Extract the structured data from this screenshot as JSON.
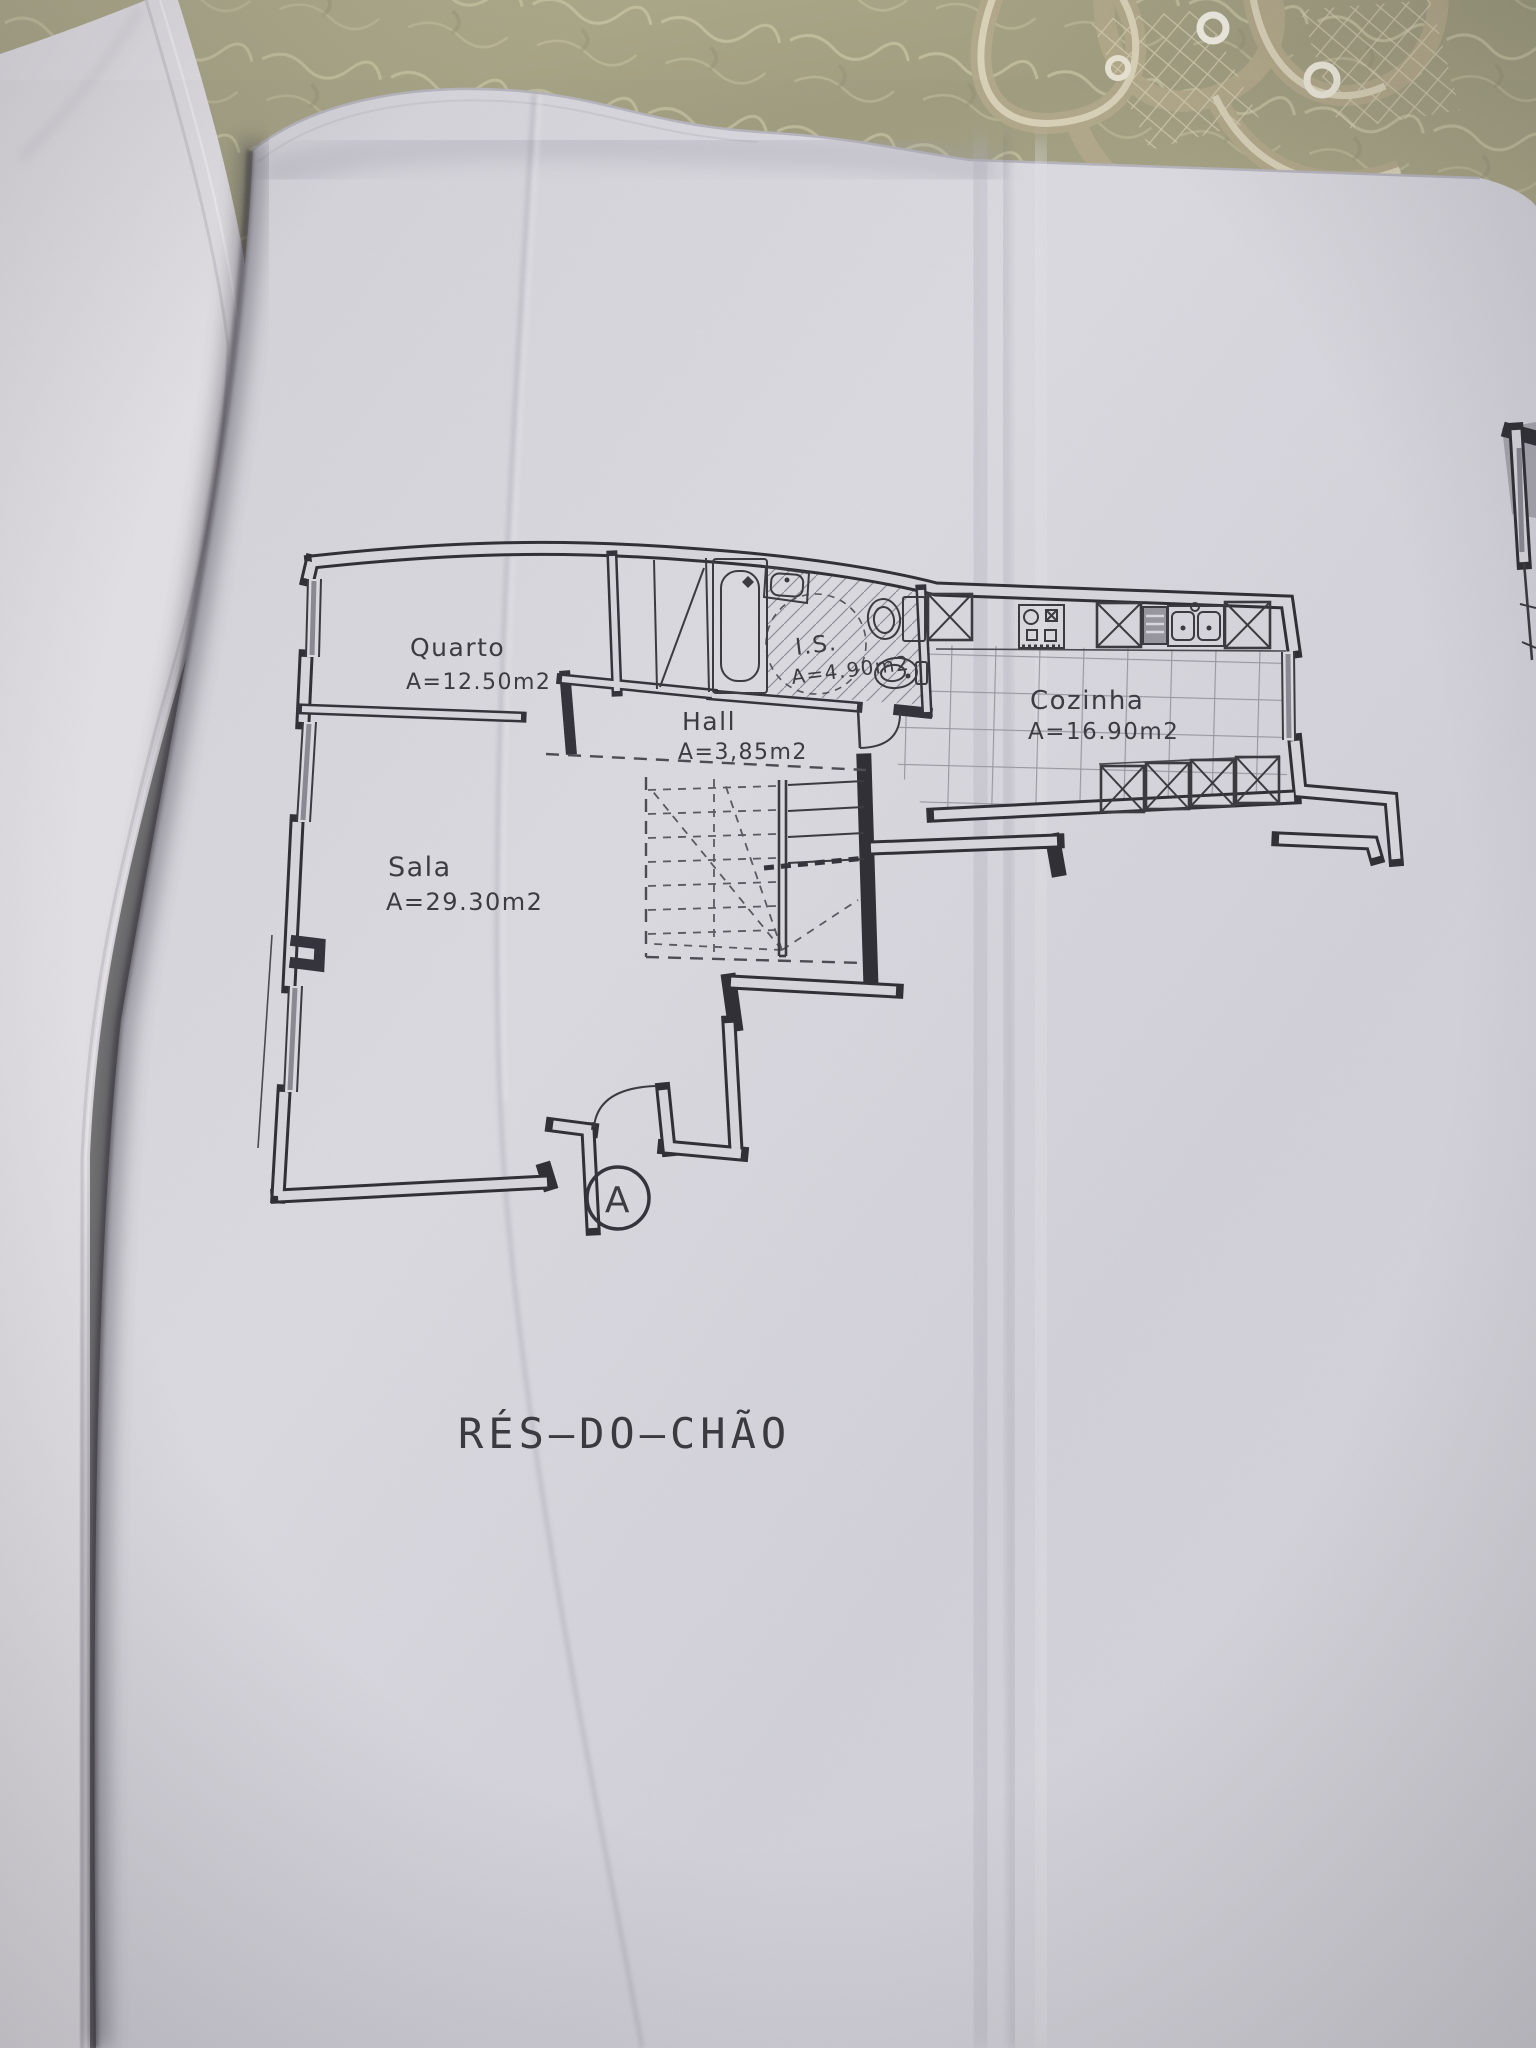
{
  "floor_plan": {
    "title": "RÉS—DO—CHÃO",
    "entrance_marker": "A",
    "rooms": [
      {
        "name": "Quarto",
        "area": "A=12.50m2"
      },
      {
        "name": "Sala",
        "area": "A=29.30m2"
      },
      {
        "name": "Hall",
        "area": "A=3,85m2"
      },
      {
        "name": "I.S.",
        "area": "A=4.90m2"
      },
      {
        "name": "Cozinha",
        "area": "A=16.90m2"
      }
    ]
  },
  "colors": {
    "paper": "#d8d7de",
    "left_page": "#e3e1e6",
    "ink": "#2f2e35",
    "tablecloth": "#a6a386",
    "lace": "#c2b897",
    "gutter_shadow": "#3f3c46"
  }
}
